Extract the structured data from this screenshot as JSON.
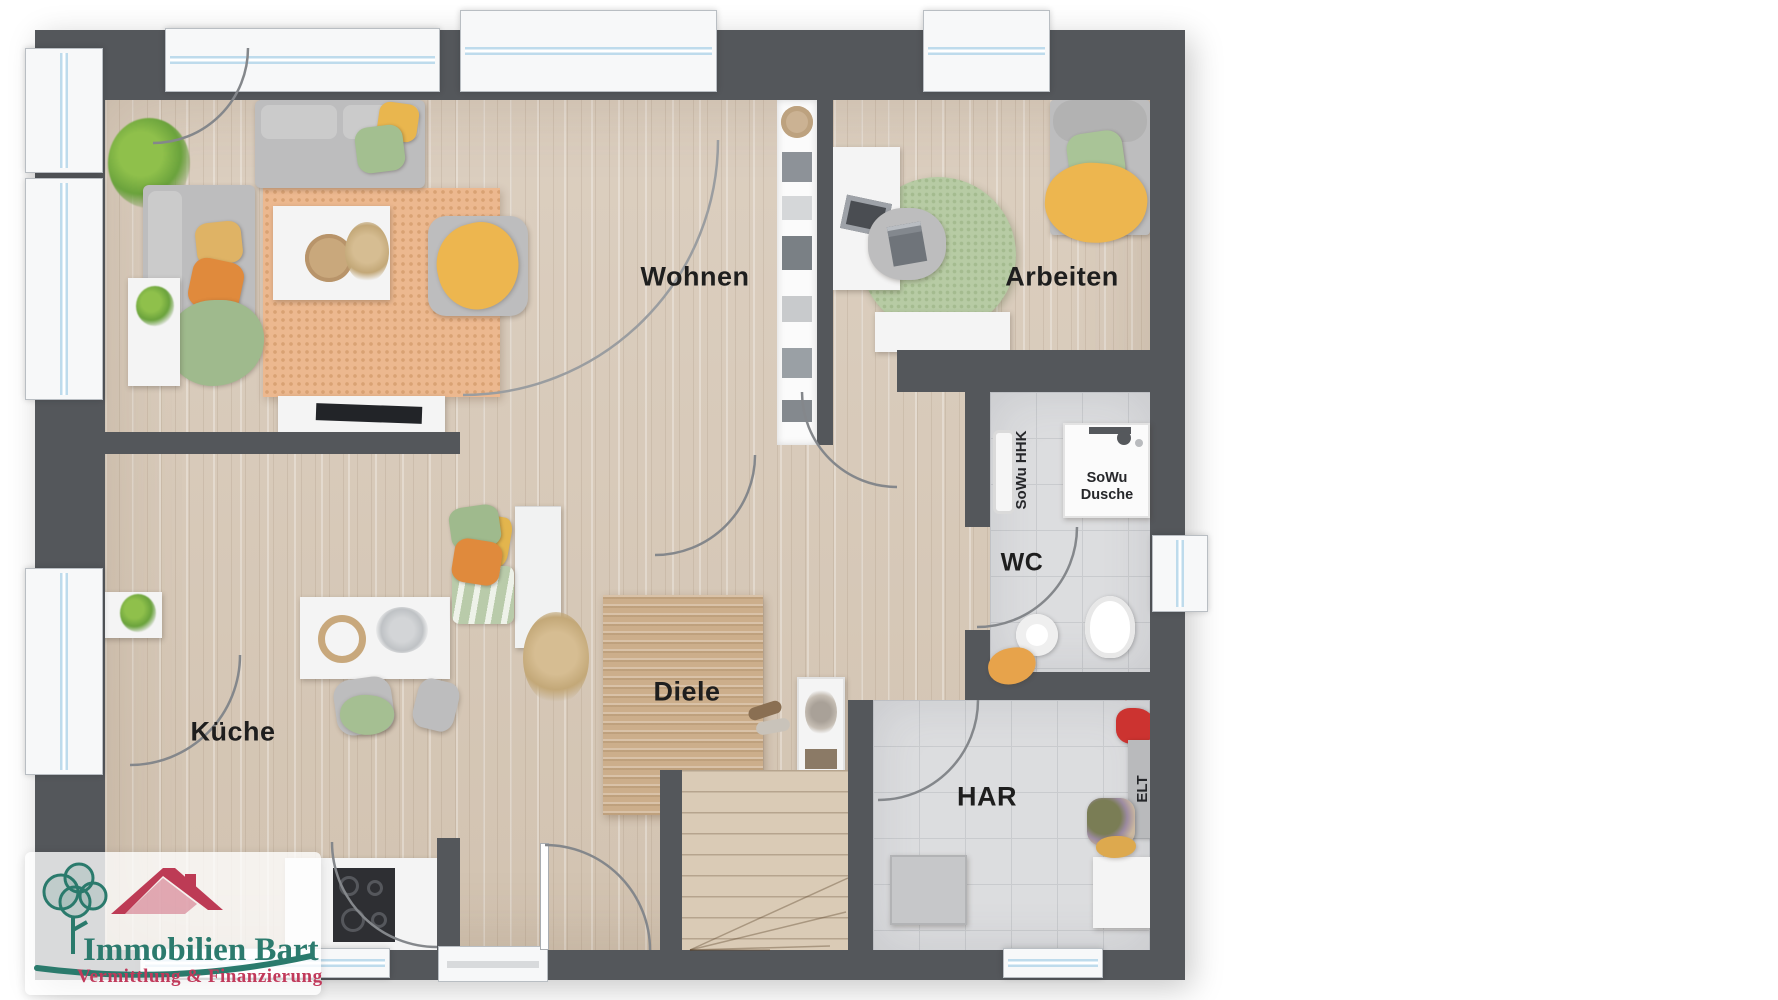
{
  "plan": {
    "rooms": {
      "living": "Wohnen",
      "office": "Arbeiten",
      "kitchen": "Küche",
      "hallway": "Diele",
      "wc": "WC",
      "utility": "HAR"
    },
    "labels": {
      "radiator": "SoWu HHK",
      "shower_line1": "SoWu",
      "shower_line2": "Dusche",
      "electrical": "ELT"
    }
  },
  "branding": {
    "company": "Immobilien Bart",
    "tagline": "Vermittlung & Finanzierung"
  },
  "colors": {
    "wall": "#54575b",
    "wood_floor": "#d8cbba",
    "tile_floor": "#dcddde",
    "logo_teal": "#2a7a6c",
    "logo_red": "#bd3b55",
    "accent_orange": "#e08a3c",
    "accent_yellow": "#e9b64e",
    "accent_green": "#a3bf90",
    "rug_terracotta": "#ebb88f"
  }
}
